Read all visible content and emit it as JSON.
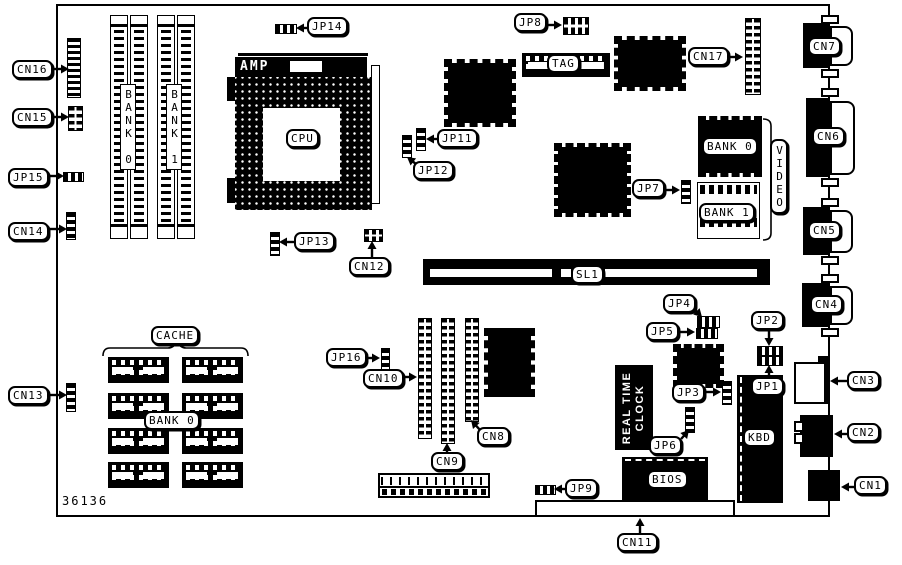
{
  "figure": {
    "part_number": "36136"
  },
  "colors": {
    "ink": "#000000",
    "paper": "#ffffff"
  },
  "chip_labels": {
    "amp": "AMP",
    "rtc_line1": "REAL TIME",
    "rtc_line2": "CLOCK"
  },
  "callouts": [
    {
      "id": "cn16",
      "text": "CN16",
      "x": 12,
      "y": 60,
      "tx": 69,
      "ty": 69
    },
    {
      "id": "cn15",
      "text": "CN15",
      "x": 12,
      "y": 108,
      "tx": 69,
      "ty": 117
    },
    {
      "id": "jp15",
      "text": "JP15",
      "x": 8,
      "y": 168,
      "tx": 64,
      "ty": 176
    },
    {
      "id": "cn14",
      "text": "CN14",
      "x": 8,
      "y": 222,
      "tx": 67,
      "ty": 229
    },
    {
      "id": "cn13",
      "text": "CN13",
      "x": 8,
      "y": 386,
      "tx": 67,
      "ty": 395
    },
    {
      "id": "jp14",
      "text": "JP14",
      "x": 307,
      "y": 17,
      "tx": 296,
      "ty": 28
    },
    {
      "id": "jp8",
      "text": "JP8",
      "x": 514,
      "y": 13,
      "tx": 562,
      "ty": 25
    },
    {
      "id": "cn17",
      "text": "CN17",
      "x": 688,
      "y": 47,
      "tx": 743,
      "ty": 57
    },
    {
      "id": "jp11",
      "text": "JP11",
      "x": 437,
      "y": 129,
      "tx": 426,
      "ty": 139
    },
    {
      "id": "jp12",
      "text": "JP12",
      "x": 413,
      "y": 161,
      "tx": 407,
      "ty": 157
    },
    {
      "id": "jp13",
      "text": "JP13",
      "x": 294,
      "y": 232,
      "tx": 279,
      "ty": 242
    },
    {
      "id": "cn12",
      "text": "CN12",
      "x": 349,
      "y": 257,
      "tx": 372,
      "ty": 241
    },
    {
      "id": "sl1",
      "text": "SL1",
      "x": 571,
      "y": 265
    },
    {
      "id": "jp7",
      "text": "JP7",
      "x": 632,
      "y": 179,
      "tx": 680,
      "ty": 190
    },
    {
      "id": "cache",
      "text": "CACHE",
      "x": 151,
      "y": 326
    },
    {
      "id": "cache-bank0",
      "text": "BANK 0",
      "x": 144,
      "y": 411
    },
    {
      "id": "jp16",
      "text": "JP16",
      "x": 326,
      "y": 348,
      "tx": 380,
      "ty": 358
    },
    {
      "id": "cn10",
      "text": "CN10",
      "x": 363,
      "y": 369,
      "tx": 417,
      "ty": 377
    },
    {
      "id": "cn9",
      "text": "CN9",
      "x": 431,
      "y": 452,
      "tx": 447,
      "ty": 443
    },
    {
      "id": "cn8",
      "text": "CN8",
      "x": 477,
      "y": 427,
      "tx": 471,
      "ty": 420
    },
    {
      "id": "jp4",
      "text": "JP4",
      "x": 663,
      "y": 294,
      "tx": 702,
      "ty": 317
    },
    {
      "id": "jp5",
      "text": "JP5",
      "x": 646,
      "y": 322,
      "tx": 695,
      "ty": 332
    },
    {
      "id": "jp2",
      "text": "JP2",
      "x": 751,
      "y": 311,
      "tx": 769,
      "ty": 346
    },
    {
      "id": "jp1",
      "text": "JP1",
      "x": 751,
      "y": 377,
      "tx": 769,
      "ty": 365
    },
    {
      "id": "jp3",
      "text": "JP3",
      "x": 672,
      "y": 383,
      "tx": 721,
      "ty": 392
    },
    {
      "id": "jp6",
      "text": "JP6",
      "x": 649,
      "y": 436,
      "tx": 689,
      "ty": 430
    },
    {
      "id": "jp9",
      "text": "JP9",
      "x": 565,
      "y": 479,
      "tx": 554,
      "ty": 489
    },
    {
      "id": "cn11",
      "text": "CN11",
      "x": 617,
      "y": 533,
      "tx": 640,
      "ty": 518
    },
    {
      "id": "cn7",
      "text": "CN7",
      "x": 808,
      "y": 37
    },
    {
      "id": "cn6",
      "text": "CN6",
      "x": 812,
      "y": 127
    },
    {
      "id": "cn5",
      "text": "CN5",
      "x": 808,
      "y": 221
    },
    {
      "id": "cn4",
      "text": "CN4",
      "x": 810,
      "y": 295
    },
    {
      "id": "cn3",
      "text": "CN3",
      "x": 847,
      "y": 371,
      "tx": 830,
      "ty": 381
    },
    {
      "id": "cn2",
      "text": "CN2",
      "x": 847,
      "y": 423,
      "tx": 834,
      "ty": 434
    },
    {
      "id": "cn1",
      "text": "CN1",
      "x": 854,
      "y": 476,
      "tx": 841,
      "ty": 487
    },
    {
      "id": "cpu",
      "text": "CPU",
      "x": 286,
      "y": 129
    },
    {
      "id": "tag",
      "text": "TAG",
      "x": 547,
      "y": 54
    },
    {
      "id": "kbd",
      "text": "KBD",
      "x": 743,
      "y": 428
    },
    {
      "id": "bios",
      "text": "BIOS",
      "x": 647,
      "y": 470
    },
    {
      "id": "video-bank0",
      "text": "BANK 0",
      "x": 702,
      "y": 137
    },
    {
      "id": "video-bank1",
      "text": "BANK 1",
      "x": 699,
      "y": 203
    },
    {
      "id": "video",
      "text": "VIDEO",
      "x": 770,
      "y": 139,
      "vertical": true
    },
    {
      "id": "simm-bank0",
      "text": "BANK 0",
      "x": 120,
      "y": 84,
      "vertical": true,
      "plain": true
    },
    {
      "id": "simm-bank1",
      "text": "BANK 1",
      "x": 166,
      "y": 84,
      "vertical": true,
      "plain": true
    }
  ]
}
